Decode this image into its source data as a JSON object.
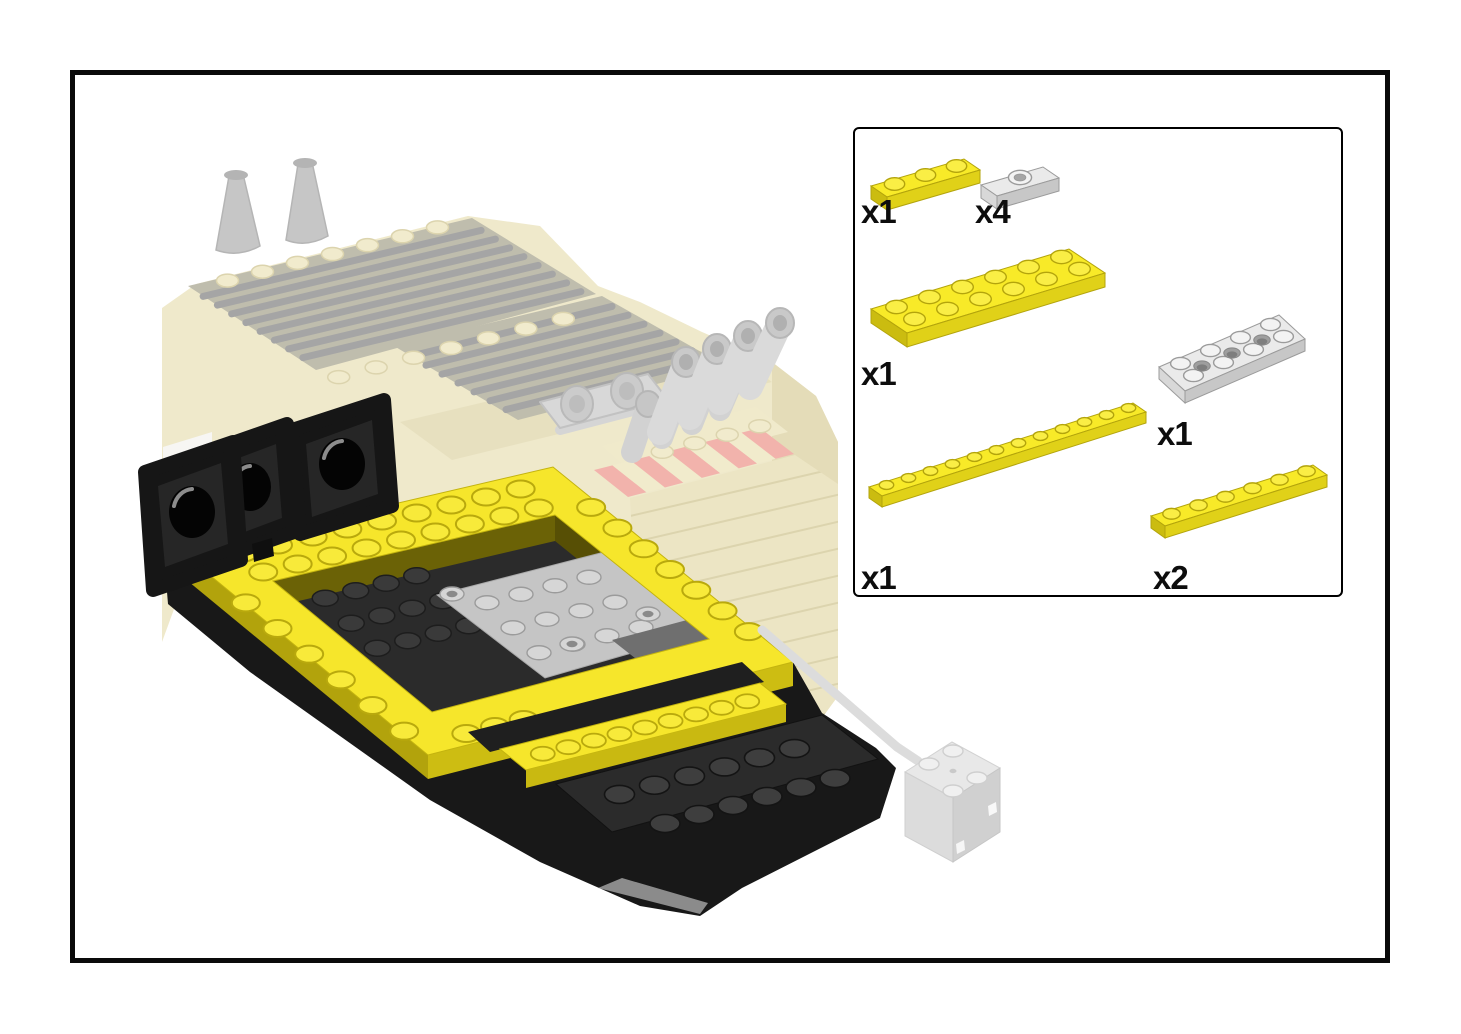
{
  "page": {
    "background": "#FFFFFF"
  },
  "frame": {
    "color": "#0A0A0A"
  },
  "illustration": {
    "colors": {
      "lego_yellow": "#F6E62B",
      "lego_yellow_dark": "#C3B30F",
      "lego_black": "#1A1A1A",
      "lego_dark_gray": "#6F6F6F",
      "lego_light_gray": "#D9D9D9",
      "ghost_cream": "#EFE9CB",
      "ghost_gray": "#D2D2D2",
      "hazard_red": "#F2B3AC"
    }
  },
  "parts_box": {
    "items": [
      {
        "qty": "x1",
        "part": "plate-1x3-yellow",
        "cols": 3,
        "rows": 1,
        "color": "yellow",
        "style": "studs"
      },
      {
        "qty": "x4",
        "part": "plate-1x2-with-center-stud-gray",
        "cols": 2,
        "rows": 1,
        "color": "gray",
        "style": "jumper"
      },
      {
        "qty": "x1",
        "part": "plate-2x6-yellow",
        "cols": 6,
        "rows": 2,
        "color": "yellow",
        "style": "studs"
      },
      {
        "qty": "x1",
        "part": "technic-plate-2x4-with-holes-gray",
        "cols": 4,
        "rows": 2,
        "color": "gray",
        "style": "technic"
      },
      {
        "qty": "x1",
        "part": "plate-1x12-yellow",
        "cols": 12,
        "rows": 1,
        "color": "yellow",
        "style": "studs"
      },
      {
        "qty": "x2",
        "part": "plate-1x6-yellow",
        "cols": 6,
        "rows": 1,
        "color": "yellow",
        "style": "studs"
      }
    ]
  }
}
